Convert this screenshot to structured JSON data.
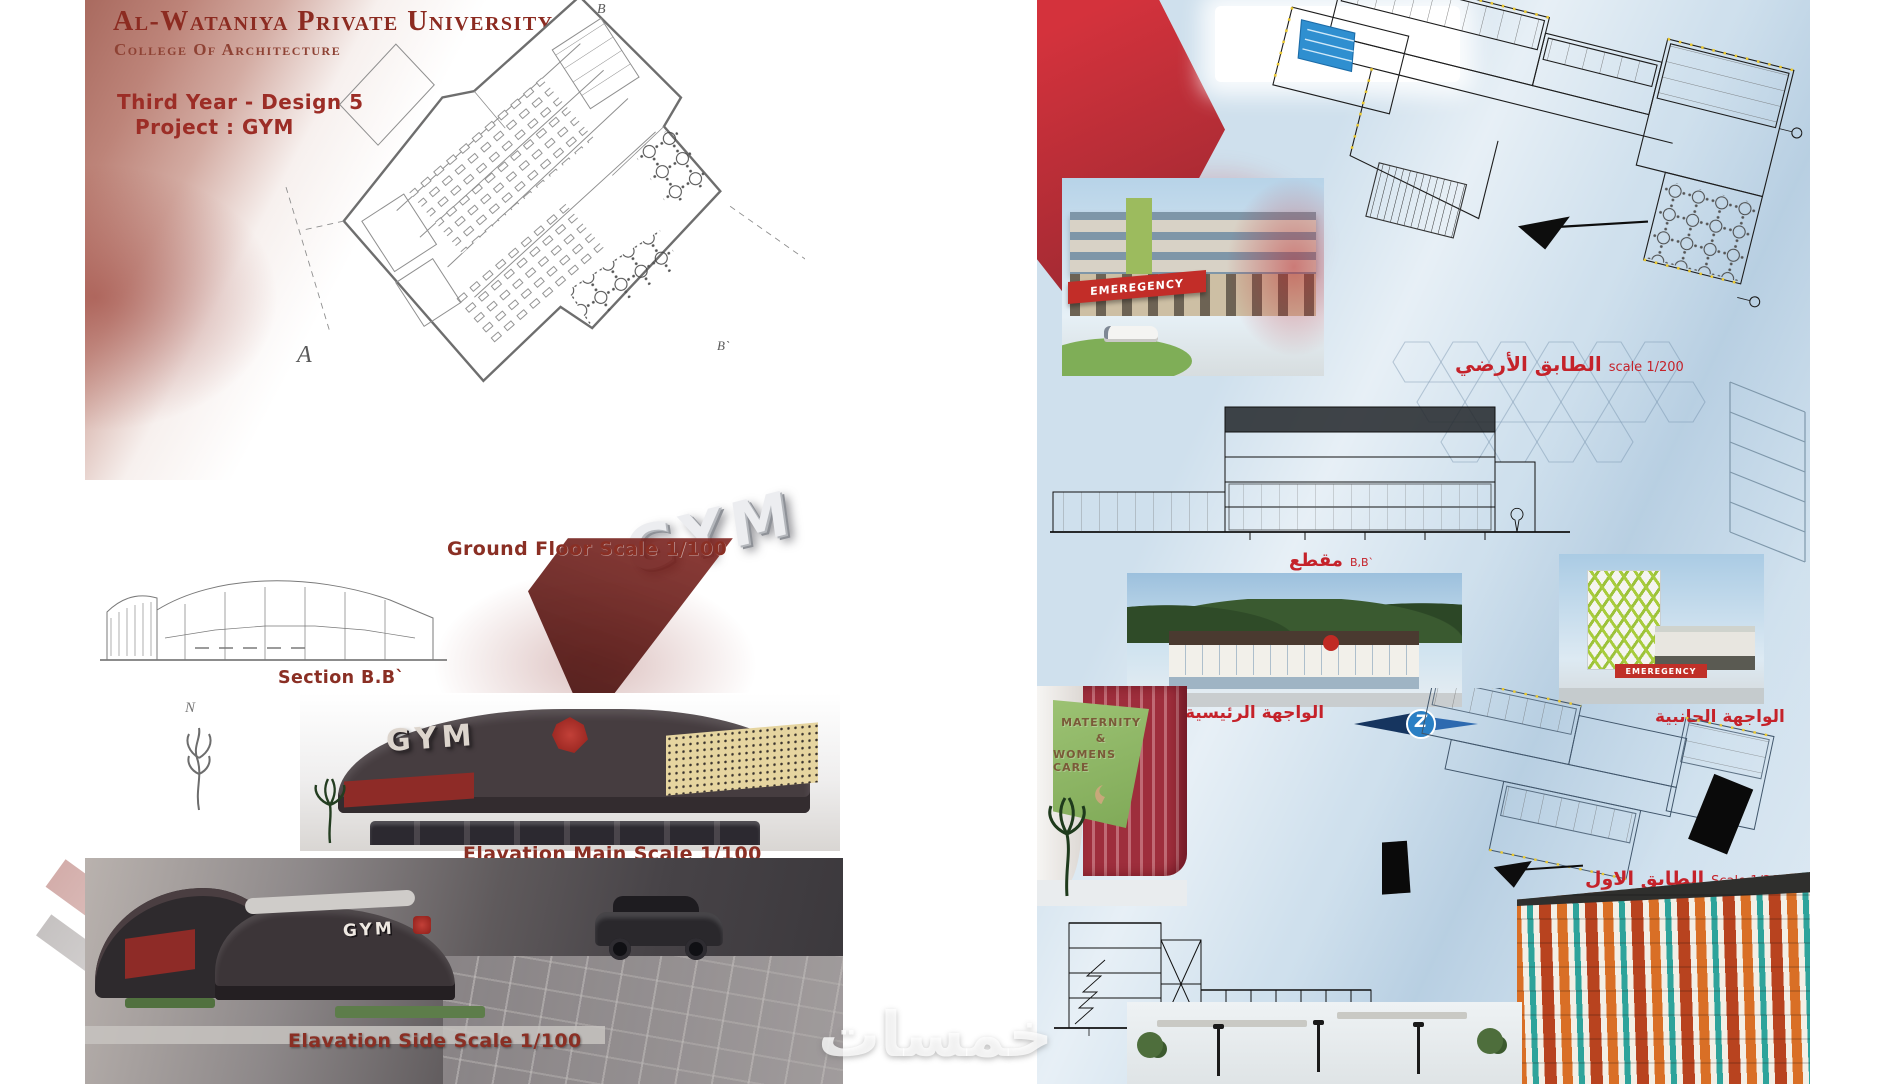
{
  "watermark": {
    "text": "خمسات"
  },
  "colors": {
    "maroon": "#8c2b21",
    "label_maroon": "#8a2f24",
    "red_label": "#c5222a",
    "board_blue": "#cfe0ed",
    "ribbon_red": "#c5232e",
    "sign_green": "#8fb964",
    "gold": "#e6d5a0",
    "dark_building": "#463d40"
  },
  "left_board": {
    "header": {
      "university": "Al-Wataniya Private University",
      "college": "College Of Architecture",
      "course": "Third Year - Design 5",
      "project": "Project : GYM"
    },
    "markers": {
      "a": "A",
      "b": "B",
      "b2": "B`",
      "north": "N"
    },
    "labels": {
      "ground_floor": "Ground Floor Scale 1/100",
      "section": "Section B.B`",
      "elevation_main": "Elavation Main Scale 1/100",
      "elevation_side": "Elavation Side Scale 1/100"
    },
    "renders": {
      "gym_letters": "GYM",
      "main_sign": "GYM",
      "side_sign": "GYM"
    }
  },
  "right_board": {
    "plans": {
      "ground_floor": {
        "title_ar": "الطابق الأرضي",
        "scale": "scale 1/200"
      },
      "first_floor": {
        "title_ar": "الطابق الاول",
        "scale": "Scale 1/200"
      }
    },
    "sections": {
      "bb": {
        "title_ar": "مقطع",
        "ref": "B,B`"
      },
      "aa": {
        "title_ar": "مقطع",
        "ref": "A,A`"
      }
    },
    "facades": {
      "main_ar": "الواجهة الرئيسية",
      "side_ar": "الواجهة الجانبية"
    },
    "renders": {
      "emergency_sign": "EMEREGENCY",
      "side_emergency_sign": "EMEREGENCY",
      "maternity_line1": "MATERNITY",
      "maternity_line2": "&",
      "maternity_line3": "WOMENS CARE",
      "compass_letter": "Z"
    }
  }
}
